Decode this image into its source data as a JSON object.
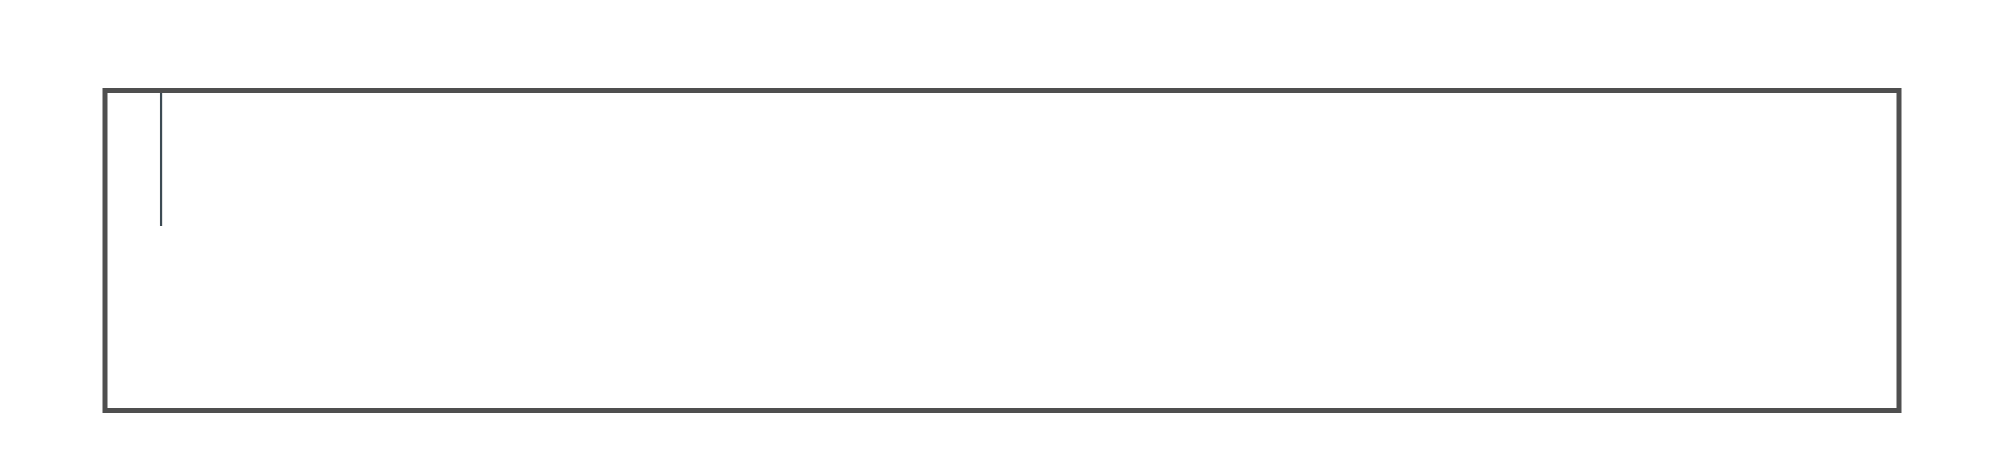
{
  "dimensions": {
    "total_width": "76 800",
    "bay_width": "2400",
    "bay_count": 32,
    "left_total": "14 000",
    "left_top": "6 000",
    "left_mid": "2 000",
    "left_bottom": "6 000"
  },
  "layout": {
    "bath_bays_per_end": 3,
    "stair_bay_index": 16,
    "toilets_per_bay_half": 6,
    "sinks_wall_per_bay_half": 4,
    "sinks_washroom_per_half": 6,
    "rooms_top": 25,
    "rooms_bottom": 25,
    "beds_per_room": 2
  },
  "watermark": {
    "text": "VANDA",
    "pink": "#e2565f",
    "blue": "#7aa8dc"
  },
  "colors": {
    "bg": "#ffffff",
    "bed": "#e9d3d7",
    "pillow": "#fdfaf4",
    "band": "#9d8c6d",
    "cabinet": "#a9562f",
    "wall": "#4f4f4f",
    "partition": "#3d4b54",
    "line": "#1c1c1c"
  }
}
